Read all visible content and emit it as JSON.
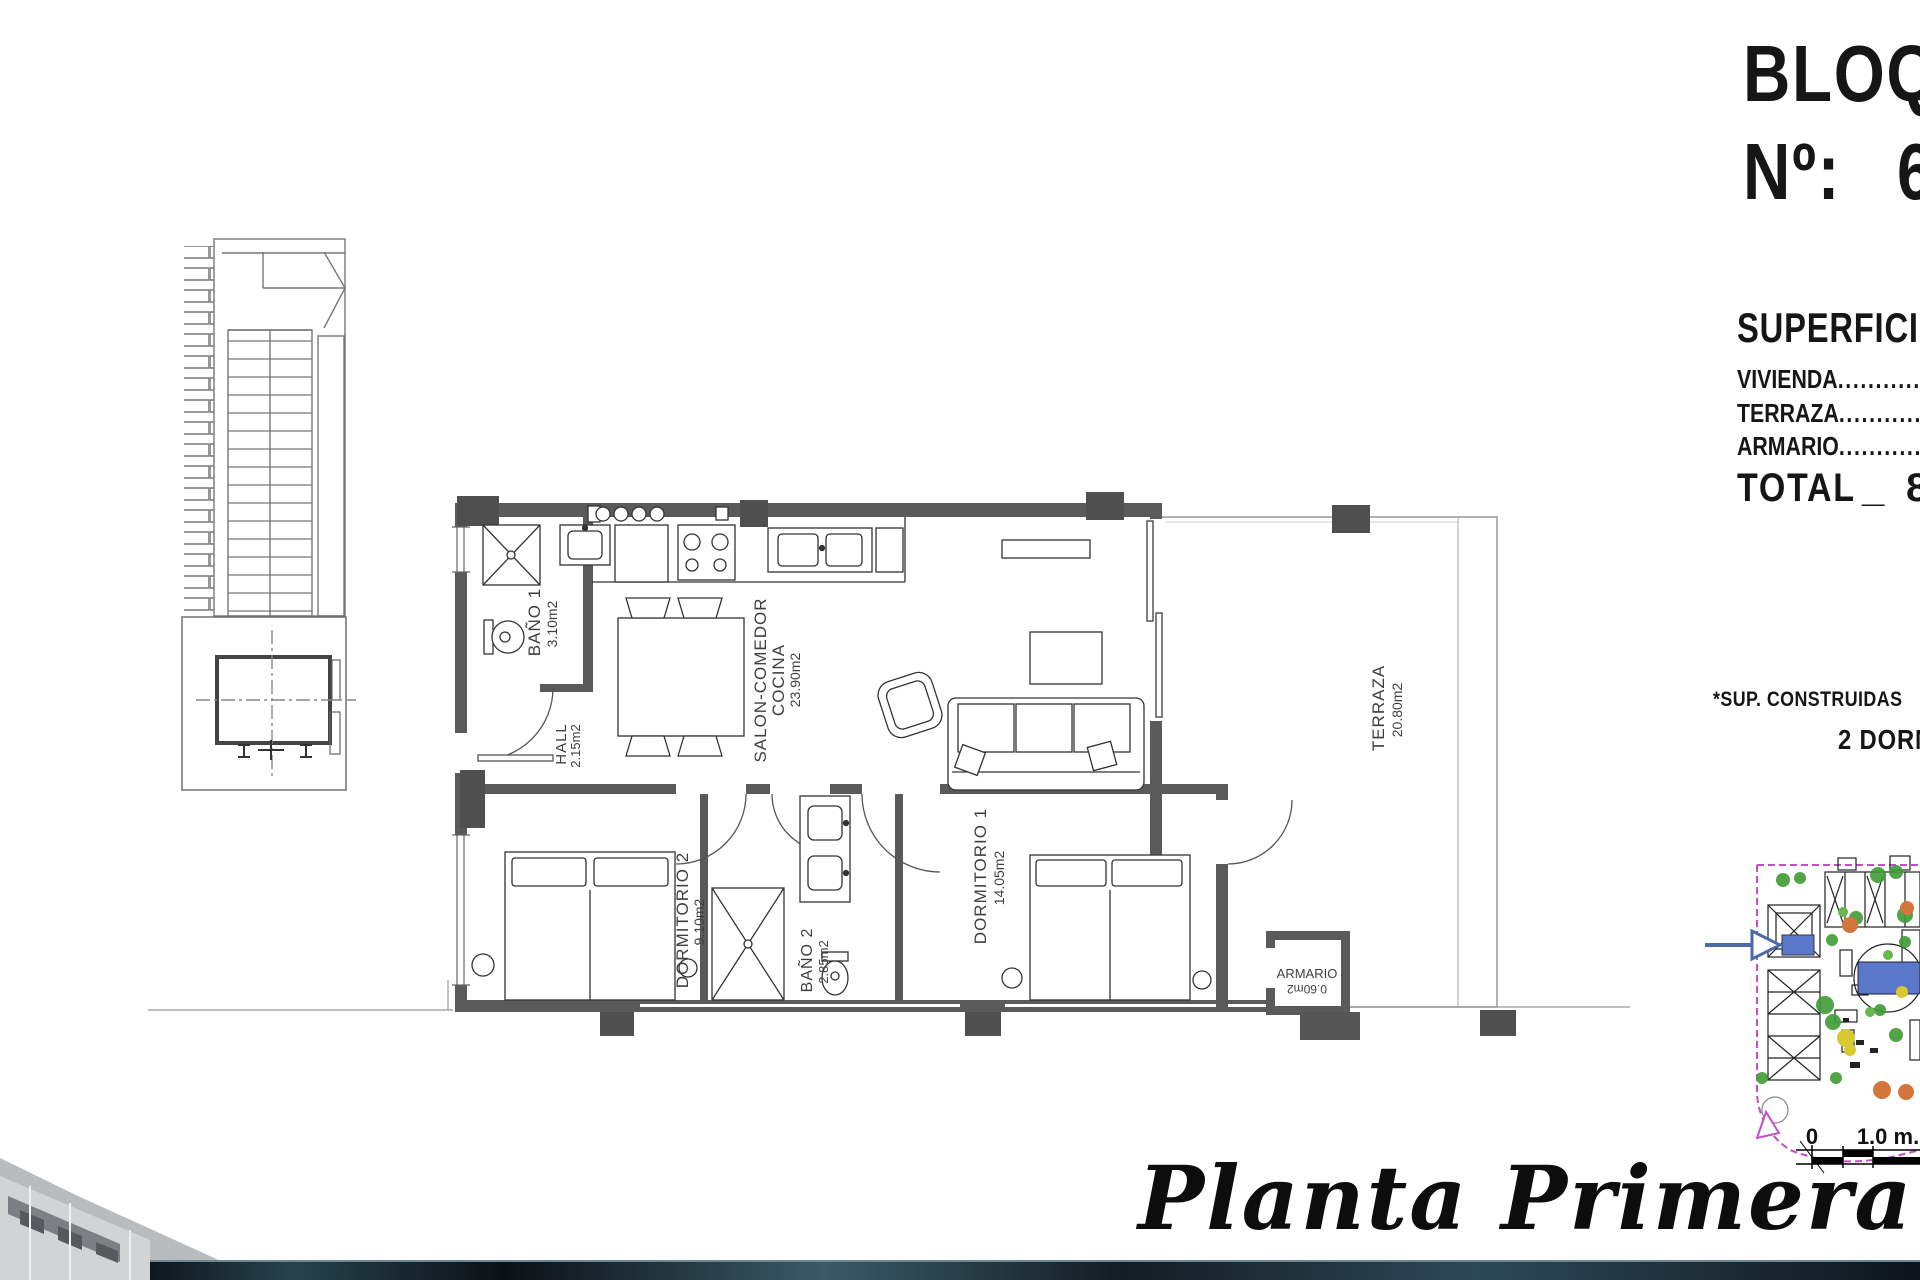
{
  "header": {
    "block_title": "BLOQUE",
    "number_label": "Nº:",
    "number_value": "6"
  },
  "superficies": {
    "title": "SUPERFICIES",
    "rows": [
      {
        "label": "VIVIENDA",
        "leader": "........................................"
      },
      {
        "label": "TERRAZA",
        "leader": "........................................"
      },
      {
        "label": "ARMARIO",
        "leader": "........................................"
      }
    ],
    "total_label": "TOTAL",
    "total_separator": "_",
    "total_value": "8"
  },
  "notes": {
    "built_surfaces": "*SUP. CONSTRUIDAS",
    "bedrooms": "2 DORMITORIOS"
  },
  "rooms": {
    "bano1": {
      "name": "BAÑO 1",
      "area": "3.10m2"
    },
    "hall": {
      "name": "HALL",
      "area": "2.15m2"
    },
    "salon": {
      "name_line1": "SALON-COMEDOR",
      "name_line2": "COCINA",
      "area": "23.90m2"
    },
    "dormitorio2": {
      "name": "DORMITORIO 2",
      "area": "9.10m2"
    },
    "bano2": {
      "name": "BAÑO 2",
      "area": "2.85m2"
    },
    "dormitorio1": {
      "name": "DORMITORIO 1",
      "area": "14.05m2"
    },
    "terraza": {
      "name": "TERRAZA",
      "area": "20.80m2"
    },
    "armario": {
      "name": "ARMARIO",
      "area": "0.60m2"
    }
  },
  "footer": {
    "plan_title": "Planta Primera"
  },
  "scale_bar": {
    "zero": "0",
    "one_meter": "1.0 m."
  },
  "colors": {
    "wall": "#5a5a5a",
    "boundary_magenta": "#c050c8",
    "highlight_blue": "#5b78c8",
    "tree_green": "#3f9b35",
    "accent_orange": "#d4763b",
    "accent_yellow": "#d8c832"
  }
}
